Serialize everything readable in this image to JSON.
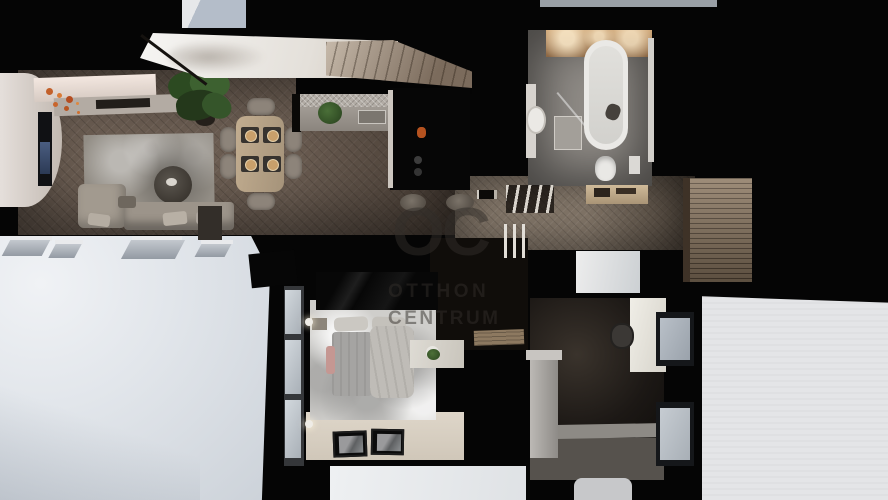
{
  "watermark": {
    "logo": "OC",
    "line1": "OTTHON",
    "line2": "CENTRUM"
  },
  "palette": {
    "canvas_black": "#050505",
    "wood_floor": "#6b5d52",
    "hall_floor": "#877a6c",
    "rug_gray": "#928d85",
    "sofa_beige": "#9c948a",
    "chair_beige": "#8d847a",
    "dining_wood": "#a5937a",
    "terrace_white": "#e2e6eb",
    "exterior_white": "#e4e5e7",
    "bath_floor": "#8f8b86",
    "tub_white": "#eae9e6",
    "bed_rug_white": "#cfcecb",
    "bedroom_floor": "#ded6c9",
    "sky_gray": "#b4bdc9",
    "plant_green": "#3d6130",
    "flower_orange": "#c3602a",
    "slat_wood": "#8d7962",
    "watermark_gray": "rgba(50,45,41,0.5)"
  },
  "scene": {
    "view": "top-down 3D apartment render",
    "rooms": [
      {
        "name": "living-room",
        "items": [
          "curved-tv-wall",
          "tv",
          "sideboard-with-flowers",
          "area-rug",
          "round-coffee-table",
          "l-shaped-sofa",
          "potted-plant"
        ]
      },
      {
        "name": "dining-area",
        "items": [
          "dining-table",
          "six-chairs",
          "four-place-settings"
        ]
      },
      {
        "name": "kitchen",
        "items": [
          "tiled-backsplash",
          "counter-with-sink",
          "black-island-with-cooktop",
          "two-bar-stools",
          "plant"
        ]
      },
      {
        "name": "staircase",
        "items": [
          "white-sloped-ceiling",
          "steps",
          "skylight-opening"
        ]
      },
      {
        "name": "hallway",
        "items": [
          "herringbone-floor",
          "coat-rack",
          "console-table",
          "stair-railing",
          "bench"
        ]
      },
      {
        "name": "bathroom",
        "items": [
          "bathtub",
          "walk-in-shower",
          "round-basin",
          "toilet",
          "lit-vanity"
        ]
      },
      {
        "name": "bedroom",
        "items": [
          "double-bed",
          "fluffy-rug",
          "black-wardrobe",
          "wall-lamps",
          "desk-with-plant",
          "two-picture-frames",
          "window-row"
        ]
      },
      {
        "name": "study",
        "items": [
          "desk",
          "office-chair",
          "two-windows",
          "pillar"
        ]
      },
      {
        "name": "terrace",
        "items": [
          "white-roof-terrace",
          "tilted-open-windows"
        ]
      },
      {
        "name": "exterior",
        "items": [
          "white-facade"
        ]
      }
    ]
  }
}
